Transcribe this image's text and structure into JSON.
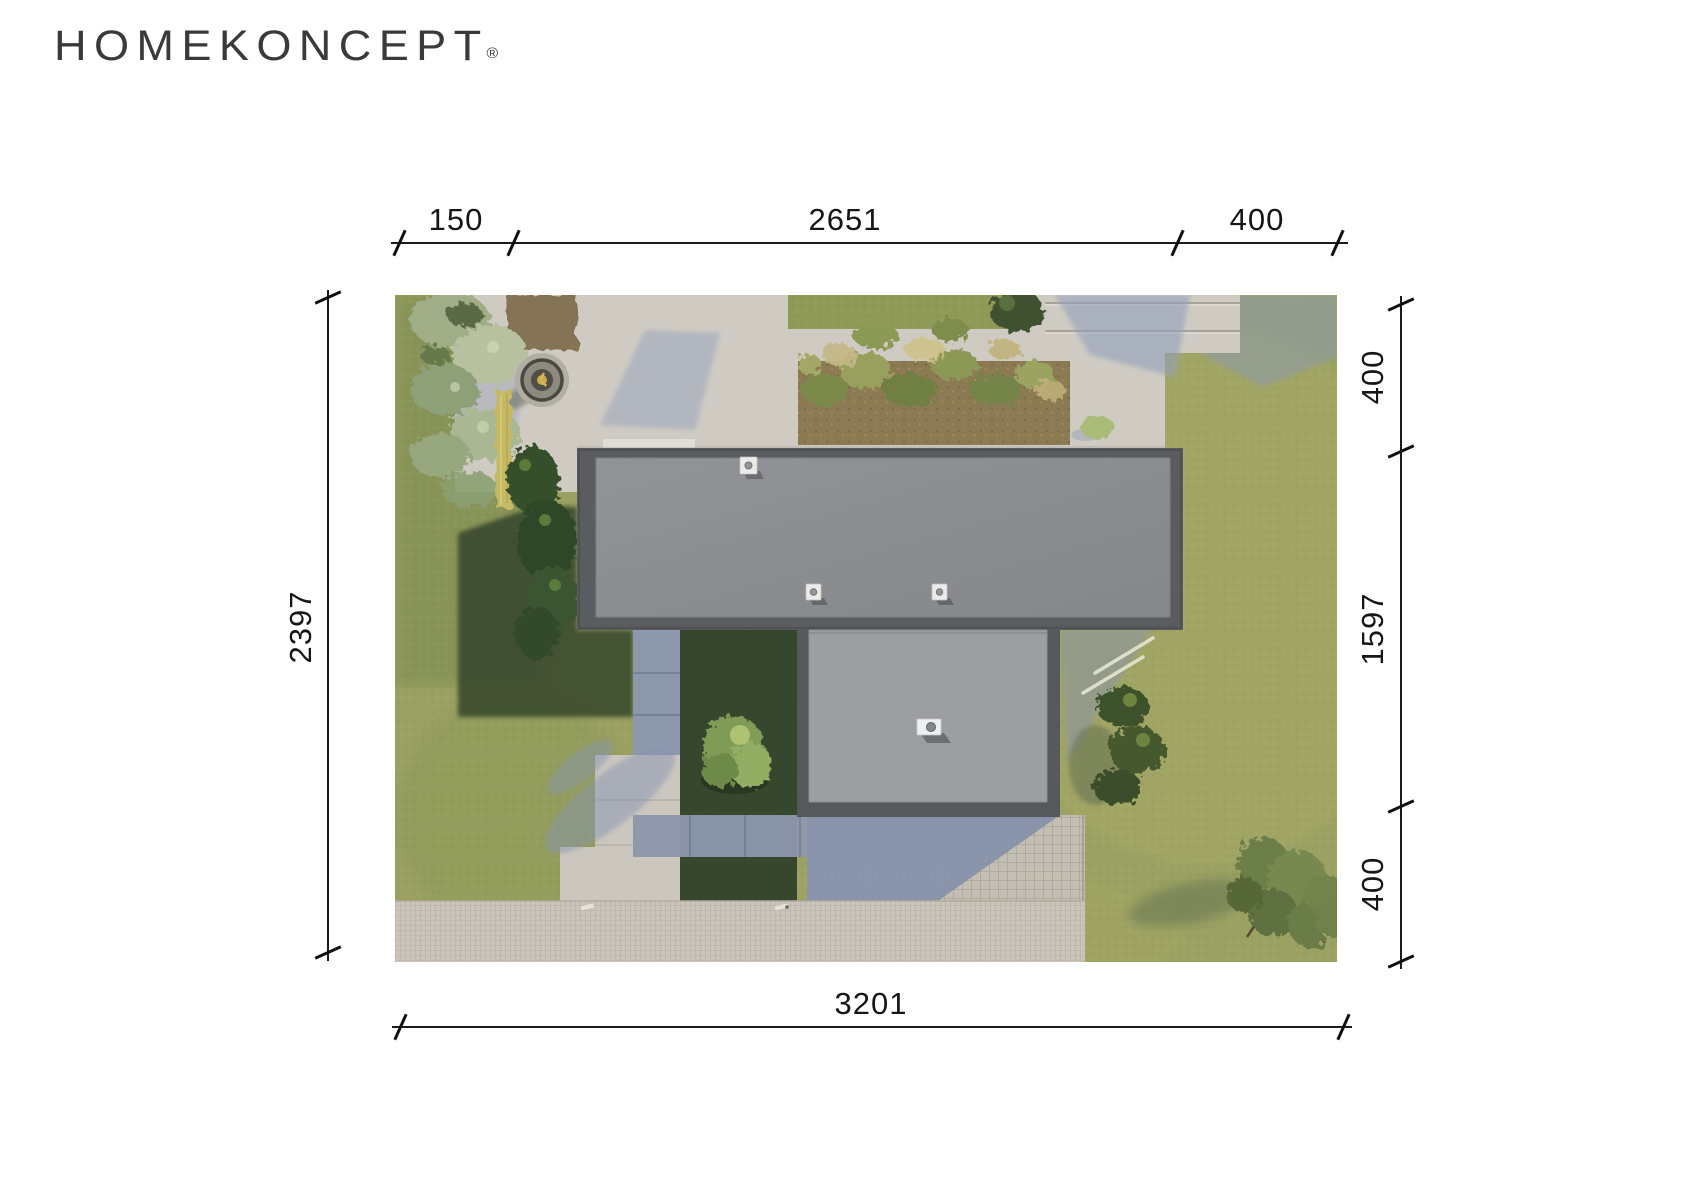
{
  "logo": {
    "text": "HOMEKONCEPT",
    "registered_mark": "®"
  },
  "dimensions": {
    "top": {
      "segments": [
        {
          "label": "150"
        },
        {
          "label": "2651"
        },
        {
          "label": "400"
        }
      ]
    },
    "right": {
      "segments": [
        {
          "label": "400"
        },
        {
          "label": "1597"
        },
        {
          "label": "400"
        }
      ]
    },
    "left": {
      "label": "2397"
    },
    "bottom": {
      "label": "3201"
    }
  },
  "scene": {
    "description": "Aerial site-plan render of a modern flat-roof house with attached garage, terrace with fire pit, planting beds, paved driveway and lawn",
    "colors": {
      "dimension_line": "#1b1b1b",
      "logo_text": "#3a3a3a",
      "main_roof": "#8c8e91",
      "garage_roof": "#9c9ea1",
      "roof_parapet": "#56585c",
      "concrete": "#cfcbc3",
      "sidewalk": "#cac4b9",
      "grass": "#9aa162",
      "shadow_blue": "#8d98ac",
      "planting_soil": "#8b7a52",
      "fire_pit_gold": "#c9a94e"
    }
  }
}
